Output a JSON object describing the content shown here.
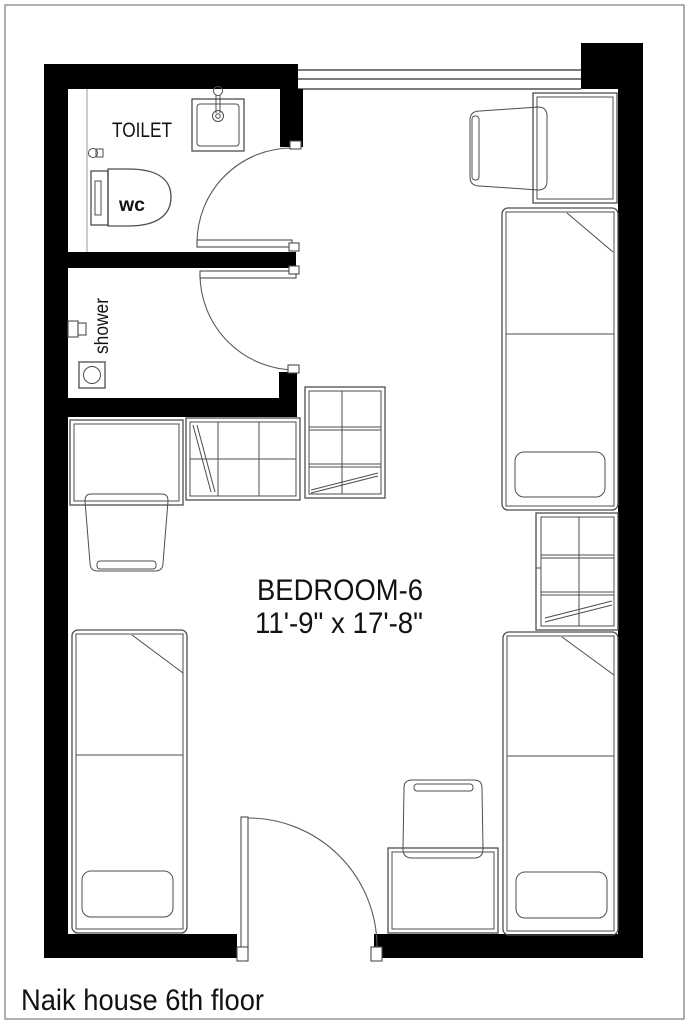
{
  "title_block": {
    "room_name": "BEDROOM-6",
    "room_size": "11'-9\" x 17'-8\"",
    "caption": "Naik house 6th floor"
  },
  "labels": {
    "toilet": "TOILET",
    "wc": "wc",
    "shower": "shower"
  },
  "colors": {
    "wall": "#000000",
    "furniture_line": "#4d4d4d",
    "door_arc": "#5a5a5a",
    "text": "#121212",
    "page_border": "#8f8f8f",
    "background": "#ffffff"
  }
}
